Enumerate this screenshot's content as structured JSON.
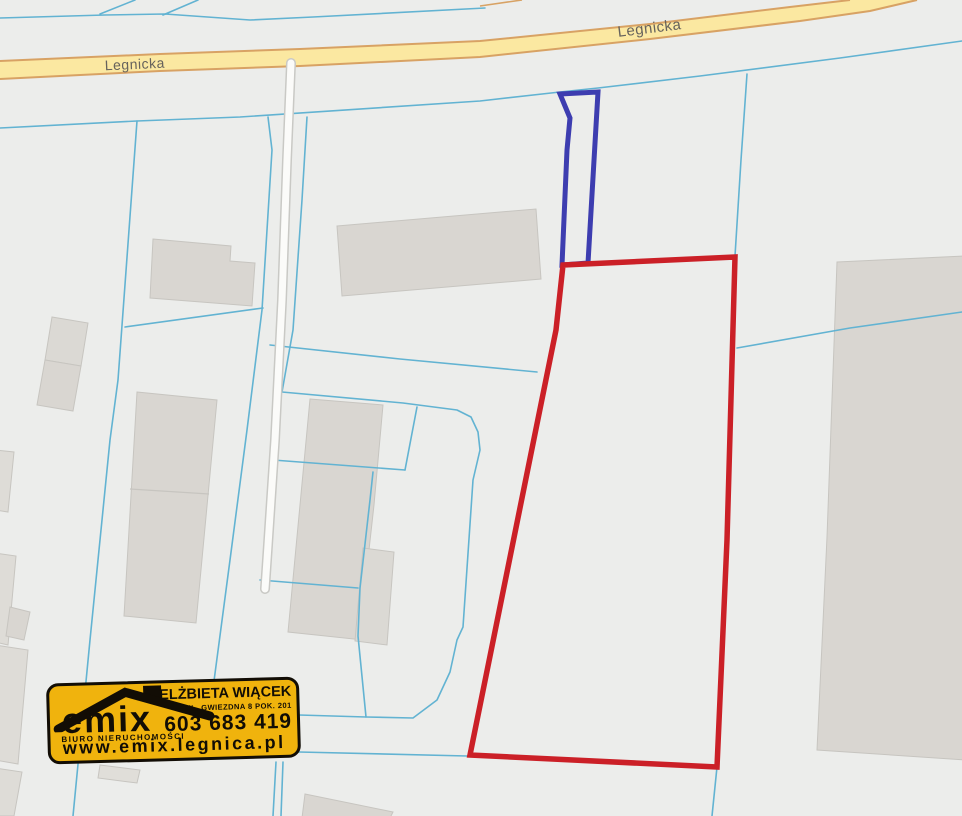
{
  "page": {
    "width": 962,
    "height": 816,
    "background": "#ecedeb"
  },
  "map": {
    "palette": {
      "background": "#ecedeb",
      "cadastral_line": "#62b3d2",
      "road_fill": "#fbe8a1",
      "road_edge": "#d8a264",
      "side_road_fill": "#fbfbf9",
      "side_road_casing": "#c9c9c5",
      "building_fill": "#d9d6d1",
      "building_edge": "#c7c5c0",
      "parcel_red": "#cb2027",
      "parcel_blue": "#3d3db0",
      "label_color": "#66625c"
    },
    "street_labels": [
      {
        "name": "street-label-legnicka-left",
        "text": "Legnicka",
        "x": 135,
        "y": 69,
        "rotate": -2.5,
        "size": 14
      },
      {
        "name": "street-label-legnicka-right",
        "text": "Legnicka",
        "x": 650,
        "y": 33,
        "rotate": -7,
        "size": 15
      }
    ],
    "main_road": {
      "fill_points": "0,61 160,54 300,49 480,41 650,24 790,7 850,0 917,0 870,11 800,21 650,39 480,57 300,66 160,71 0,79",
      "top_edge": "0,61 160,54 300,49 480,41 650,24 790,7 850,0",
      "bottom_edge": "917,0 870,11 800,21 650,39 480,57 300,66 160,71 0,79",
      "stub": "480,6 522,0"
    },
    "side_road": {
      "points": "291,63 287,160 282,300 275,440 268,545 265,589"
    },
    "cadastral_lines": [
      {
        "name": "boundary-top-left",
        "points": "0,18 105,15 165,14 250,20 313,17 485,8"
      },
      {
        "name": "boundary-spur-a",
        "points": "100,14 135,0"
      },
      {
        "name": "boundary-spur-b",
        "points": "163,15 198,0"
      },
      {
        "name": "boundary-long-diagonal",
        "points": "962,41 840,58 700,76 598,88 560,92 480,101 240,117 137,121 0,128"
      },
      {
        "name": "boundary-branch-red",
        "points": "747,74 741,160 735,256"
      },
      {
        "name": "boundary-right-cross",
        "points": "737,348 850,328 962,312"
      },
      {
        "name": "boundary-below-red",
        "points": "717,767 712,816"
      },
      {
        "name": "boundary-bottom-horiz",
        "points": "299,752 467,756"
      },
      {
        "name": "boundary-mid-curve",
        "points": "299,715 366,717 413,718 437,700 450,672 457,640 463,627 473,480 480,450 478,432 471,417 457,410 403,403 282,392"
      },
      {
        "name": "boundary-horiz-mid",
        "points": "273,460 405,470"
      },
      {
        "name": "boundary-vert-short",
        "points": "417,407 405,470"
      },
      {
        "name": "boundary-horiz-small",
        "points": "260,580 358,588"
      },
      {
        "name": "boundary-left-long",
        "points": "137,121 118,380 110,440 90,640 73,816"
      },
      {
        "name": "boundary-horiz-left",
        "points": "125,327 263,308"
      },
      {
        "name": "boundary-road-flank-left",
        "points": "268,117 272,150 262,310 247,430 230,560 214,681"
      },
      {
        "name": "boundary-stub-a",
        "points": "276,762 273,816"
      },
      {
        "name": "boundary-stub-b",
        "points": "283,762 281,816"
      },
      {
        "name": "boundary-road-flank-right",
        "points": "307,117 302,200 293,330 282,392"
      },
      {
        "name": "boundary-mid-vertical",
        "points": "373,472 370,500 360,588 358,636 366,717"
      },
      {
        "name": "boundary-to-red-mid",
        "points": "270,345 400,359 537,372"
      }
    ],
    "buildings": [
      {
        "name": "building-top-center",
        "points": "337,226 536,209 541,279 342,296",
        "fill": "#d9d6d1"
      },
      {
        "name": "building-l-shape",
        "points": "153,239 231,246 230,261 255,263 252,306 150,298",
        "fill": "#d9d6d1"
      },
      {
        "name": "building-small-upper",
        "points": "52,317 88,323 81,366 45,360",
        "fill": "#dbd9d4"
      },
      {
        "name": "building-small-lower",
        "points": "45,360 81,366 73,411 37,405",
        "fill": "#d9d6d1"
      },
      {
        "name": "building-central-tall",
        "points": "137,392 217,400 196,623 124,616",
        "fill": "#d9d6d1"
      },
      {
        "name": "building-right-of-road",
        "points": "310,399 383,405 374,505 369,550 363,640 288,632",
        "fill": "#d9d6d1"
      },
      {
        "name": "building-annex",
        "points": "363,548 394,552 387,645 355,641",
        "fill": "#dbd9d4"
      },
      {
        "name": "building-far-right",
        "points": "837,262 965,256 965,760 817,750 827,537",
        "fill": "#d9d6d1"
      },
      {
        "name": "building-bottom-center",
        "points": "305,794 393,812 390,818 302,818",
        "fill": "#d9d6d1"
      },
      {
        "name": "building-edge-1",
        "points": "-5,450 14,452 8,512 -5,510",
        "fill": "#dedcd7"
      },
      {
        "name": "building-edge-2",
        "points": "-5,553 16,556 8,645 -5,642",
        "fill": "#dedcd7"
      },
      {
        "name": "building-edge-3",
        "points": "-5,645 28,650 18,764 -5,760",
        "fill": "#dedcd7"
      },
      {
        "name": "building-edge-4",
        "points": "10,607 30,612 24,640 6,636",
        "fill": "#d9d6d1"
      },
      {
        "name": "building-edge-5",
        "points": "-5,768 22,772 14,816 -5,816",
        "fill": "#dedcd7"
      },
      {
        "name": "building-tiny-bottom",
        "points": "100,765 140,770 137,783 98,778",
        "fill": "#e0ded9"
      }
    ],
    "building_dividers": [
      {
        "points": "130,489 209,494"
      }
    ],
    "parcels": [
      {
        "name": "parcel-outline-blue",
        "points": "560,94 598,92 588,263 562,265 567,150 570,118",
        "color": "#3d3db0",
        "width": 5
      },
      {
        "name": "parcel-outline-red",
        "points": "563,265 735,257 727,540 717,767 470,755 556,330",
        "color": "#cb2027",
        "width": 5.5
      }
    ]
  },
  "watermark": {
    "brand": "emix",
    "tagline": "BIURO NIERUCHOMOŚCI",
    "agent_name": "ELŻBIETA WIĄCEK",
    "address": "UL. GWIEZDNA 8 POK. 201",
    "phone": "603 683 419",
    "website": "www.emix.legnica.pl",
    "background": "#f0b30d"
  }
}
